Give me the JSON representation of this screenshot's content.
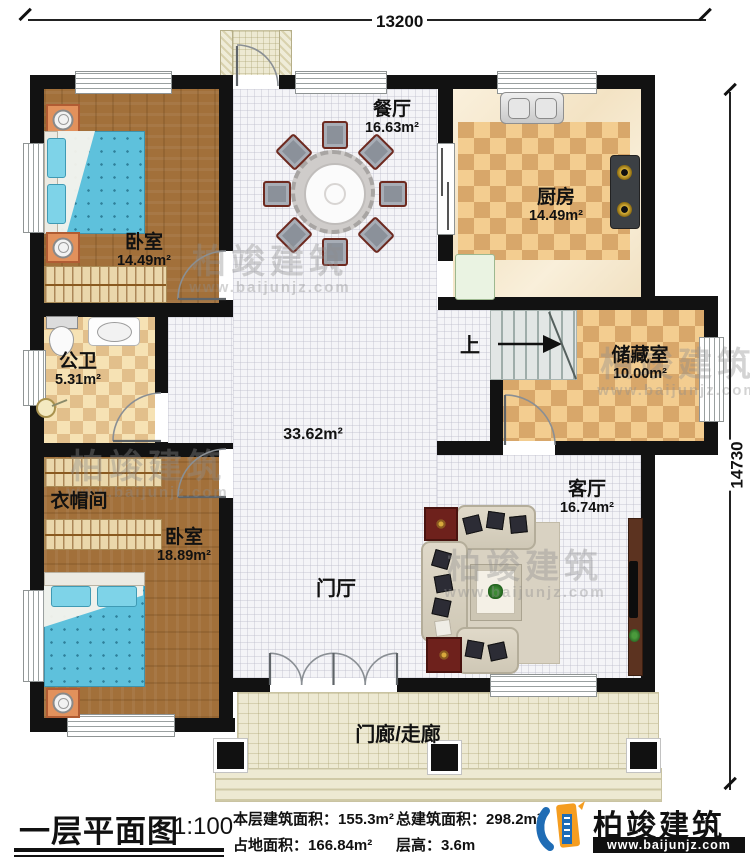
{
  "dimensions": {
    "top": "13200",
    "right": "14730"
  },
  "rooms": {
    "bedroom1": {
      "name": "卧室",
      "area": "14.49m²"
    },
    "dining": {
      "name": "餐厅",
      "area": "16.63m²"
    },
    "kitchen": {
      "name": "厨房",
      "area": "14.49m²"
    },
    "bathroom": {
      "name": "公卫",
      "area": "5.31m²"
    },
    "storage": {
      "name": "储藏室",
      "area": "10.00m²"
    },
    "cloakroom": {
      "name": "衣帽间"
    },
    "bedroom2": {
      "name": "卧室",
      "area": "18.89m²"
    },
    "living": {
      "name": "客厅",
      "area": "16.74m²"
    },
    "hall": {
      "area": "33.62m²"
    },
    "foyer": {
      "name": "门厅"
    },
    "porch": {
      "name": "门廊/走廊"
    },
    "stairs": {
      "up_label": "上"
    }
  },
  "footer": {
    "title": "一层平面图",
    "scale": "1:100",
    "stats": [
      {
        "label": "本层建筑面积：",
        "value": "155.3m²"
      },
      {
        "label": "占地面积：",
        "value": "166.84m²"
      },
      {
        "label": "总建筑面积：",
        "value": "298.2m²"
      },
      {
        "label": "层高：",
        "value": "3.6m"
      }
    ],
    "brand": {
      "name": "柏竣建筑",
      "url": "www.baijunjz.com"
    }
  },
  "watermark": {
    "text": "柏竣建筑",
    "url": "www.baijunjz.com"
  },
  "colors": {
    "wall": "#121212",
    "wood": "#a2703a",
    "tile": "#f4f4f7",
    "checker_light": "#f3cd90",
    "checker_dark": "#d8a76a",
    "bed_blue": "#5ec1dc",
    "brand_blue": "#1f6cb5",
    "brand_orange": "#f59d20"
  }
}
